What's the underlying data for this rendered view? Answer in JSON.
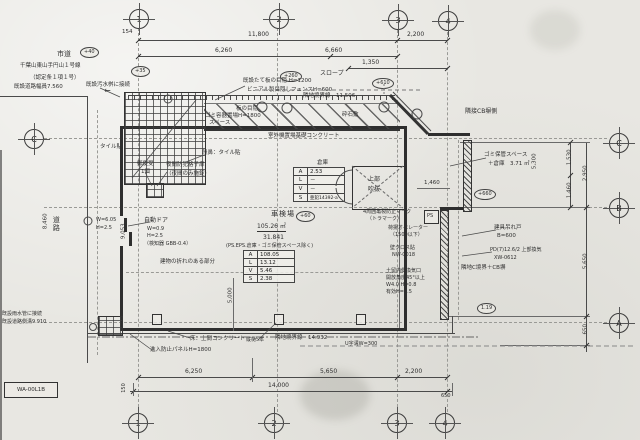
{
  "palette": {
    "paper": "#e8e7e2",
    "ink": "#2b2b2b",
    "line": "#444444"
  },
  "grid_bubbles": {
    "top": [
      "1",
      "2",
      "3",
      "4"
    ],
    "bottom": [
      "1",
      "2",
      "3",
      "4"
    ],
    "left": [
      "C"
    ],
    "right": [
      "C",
      "B",
      "A"
    ]
  },
  "dims": {
    "top": {
      "offset": "154",
      "total": "11,800",
      "seg1": "6,260",
      "seg2": "6,660",
      "seg3": "1,350",
      "right": "2,200"
    },
    "bottom": {
      "seg1": "6,250",
      "seg2": "5,650",
      "seg3": "2,200",
      "total": "14,000",
      "right": "650",
      "left": "150"
    },
    "right": {
      "a": "1,530",
      "b": "2,950",
      "c": "1,460",
      "d": "5,650",
      "e": "650",
      "f": "5,300"
    },
    "interior": {
      "v5000": "5,000",
      "g1460": "1,460",
      "road_len": "8,460",
      "wall_len": "9,053"
    }
  },
  "markers": {
    "m40": "+40",
    "m35": "+35",
    "m260": "+260",
    "m610": "+610",
    "m60": "+60",
    "m660": "+660",
    "m119": "1.19"
  },
  "labels": {
    "road_type": "市道",
    "road_name": "千葉山東山手円山１号線",
    "road_note": "（認定条１項１号）",
    "road_width": "既設道路幅員7.560",
    "sewer_top": "既設汚水桝に接続",
    "fence1": "既設たて板の目隠 H=1200",
    "fence2": "ビニアル製目隠しフェンスH=600",
    "slope": "スロープ",
    "boundary_top": "隣地境界線　11.506",
    "gravel": "砕石敷",
    "board_fence1": "板の目隠",
    "board_fence2": "H=1800",
    "trash_box1": "ゴミ容器置場",
    "trash_box2": "スペース",
    "outdoor_unit": "室外機置場基礎コンクリート",
    "nosing": "段鼻：タイル貼",
    "adjacent_cb": "隣接CB塀側",
    "tile": "タイル貼",
    "mailbox1": "郵便受",
    "mailbox2": "1個",
    "night1": "夜間防犯格子扉",
    "night2": "（夜間のみ施錠）",
    "door1": "自動ドア",
    "door2": "W=0.9",
    "door3": "H=2.5",
    "door4": "（検知器 GBB-0.4）",
    "road_label": "道路",
    "sd1": "W=6.05",
    "sd2": "H=2.5",
    "bend": "建物の折れのある部分",
    "void1": "上部",
    "void2": "吹抜",
    "trash_space1": "ゴミ保管スペース",
    "trash_space2": "＋倉庫　3.71 ㎡",
    "tora1": "4周囲亀裂防止マーク",
    "tora2": "（トラマーク）",
    "ps": "PS",
    "operator1": "荷揚オペレーター",
    "operator2": "（1500以下）",
    "cross1": "壁クロス貼",
    "cross2": "NW-0018",
    "hanging1": "建具吊れ戸",
    "hanging2": "B=600",
    "pd1": "PD(7)12.6/2 上部換気",
    "pd2": "XW-0612",
    "cb_wall": "隣地C境界＋CB塀",
    "vent1": "土留内側換気口",
    "vent2": "開放角度45°以上",
    "vent3": "W4.0 H=0.8",
    "vent4": "有効H=0.5",
    "floor": "床：土間コンクリート",
    "panel": "進入防止パネルH=1800",
    "pipes": "縦樋5本",
    "boundary_bottom": "隣地境界線　14.932",
    "ditch": "U字溝W=300",
    "sewer_b1": "既設雨水管に接続",
    "sewer_b2": "既設道路側溝9.910",
    "stamp": "WA-00L1B",
    "arrow": "←"
  },
  "room": {
    "name": "車検場",
    "area_m2": "105.26 ㎡",
    "area_tsubo": "31.841",
    "note": "(PS.EPS.倉庫・ゴミ保管スペース除く)"
  },
  "tables": {
    "storage": {
      "title": "倉庫",
      "rows": [
        [
          "A",
          "2.53"
        ],
        [
          "L",
          "－"
        ],
        [
          "V",
          "－"
        ],
        [
          "S",
          "亜鉛14392-a"
        ]
      ]
    },
    "main": {
      "rows": [
        [
          "A",
          "108.05"
        ],
        [
          "L",
          "13.12"
        ],
        [
          "V",
          "5.46"
        ],
        [
          "S",
          "2.38"
        ]
      ]
    }
  }
}
